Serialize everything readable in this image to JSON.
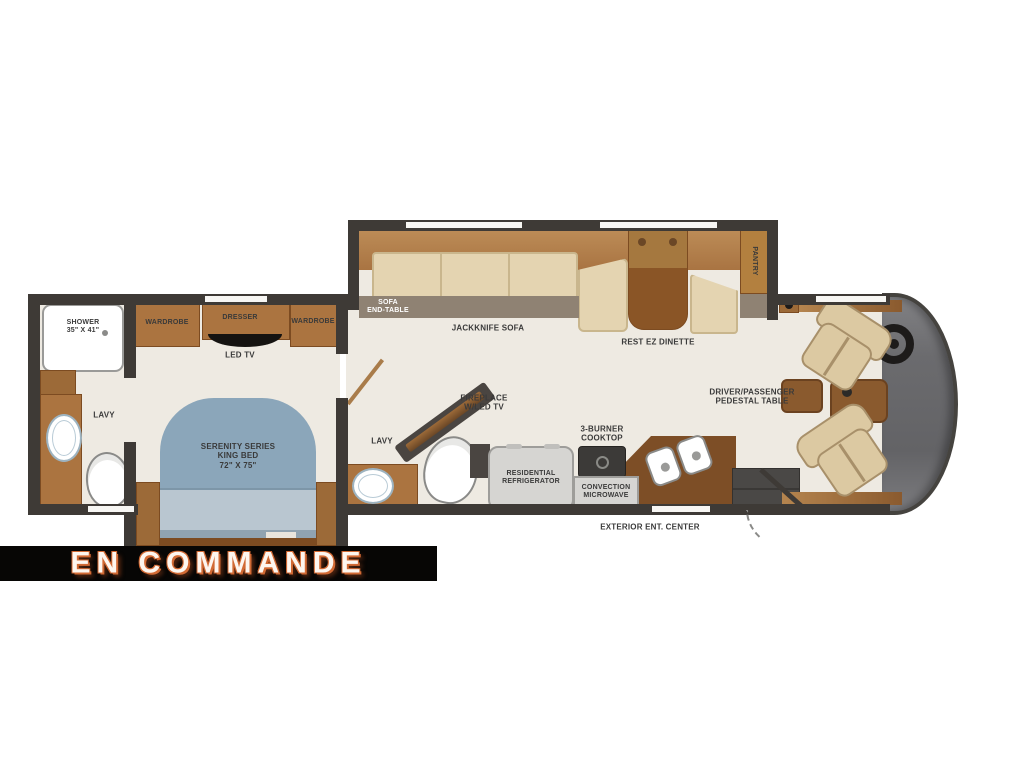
{
  "banner": {
    "text": "EN COMMANDE"
  },
  "labels": {
    "shower": "SHOWER\n35\" X 41\"",
    "wardrobe_left": "WARDROBE",
    "dresser": "DRESSER",
    "wardrobe_right": "WARDROBE",
    "led_tv": "LED TV",
    "sofa_end_table": "SOFA\nEND-TABLE",
    "jackknife_sofa": "JACKKNIFE SOFA",
    "rest_ez_dinette": "REST EZ DINETTE",
    "pantry": "PANTRY",
    "driver_passenger_table": "DRIVER/PASSENGER\nPEDESTAL TABLE",
    "lavy_rear": "LAVY",
    "lavy_mid": "LAVY",
    "king_bed": "SERENITY SERIES\nKING BED\n72\" X 75\"",
    "fireplace": "FIREPLACE\nW/LED TV",
    "refrigerator": "RESIDENTIAL\nREFRIGERATOR",
    "cooktop": "3-BURNER\nCOOKTOP",
    "microwave": "CONVECTION\nMICROWAVE",
    "exterior_ent_center": "EXTERIOR ENT. CENTER"
  },
  "colors": {
    "page_bg": "#ffffff",
    "wall": "#3e3a36",
    "floor": "#eeeae2",
    "cabinet": "#ab7440",
    "cabinet_dark": "#7c4b21",
    "counter_dark": "#7d4e26",
    "cushion": "#e4d4b1",
    "cushion_border": "#c9b68d",
    "sofa_back": "#b5854f",
    "base_taupe": "#8f8273",
    "bed_blue": "#8ba6ba",
    "bed_blue_light": "#b9c6d0",
    "bed_blue_mid": "#90a3b1",
    "appliance_gray": "#d6d5d2",
    "dark_appliance": "#3c3a38",
    "chair_cream": "#dcc9a2",
    "chair_border": "#a8906a",
    "label_ink": "#3a3a3a",
    "banner_bg": "#070605",
    "banner_text": "#fdf6ef",
    "banner_glow": "#d26a34",
    "white_fixture": "#ffffff",
    "fixture_border": "#9a9a98"
  }
}
